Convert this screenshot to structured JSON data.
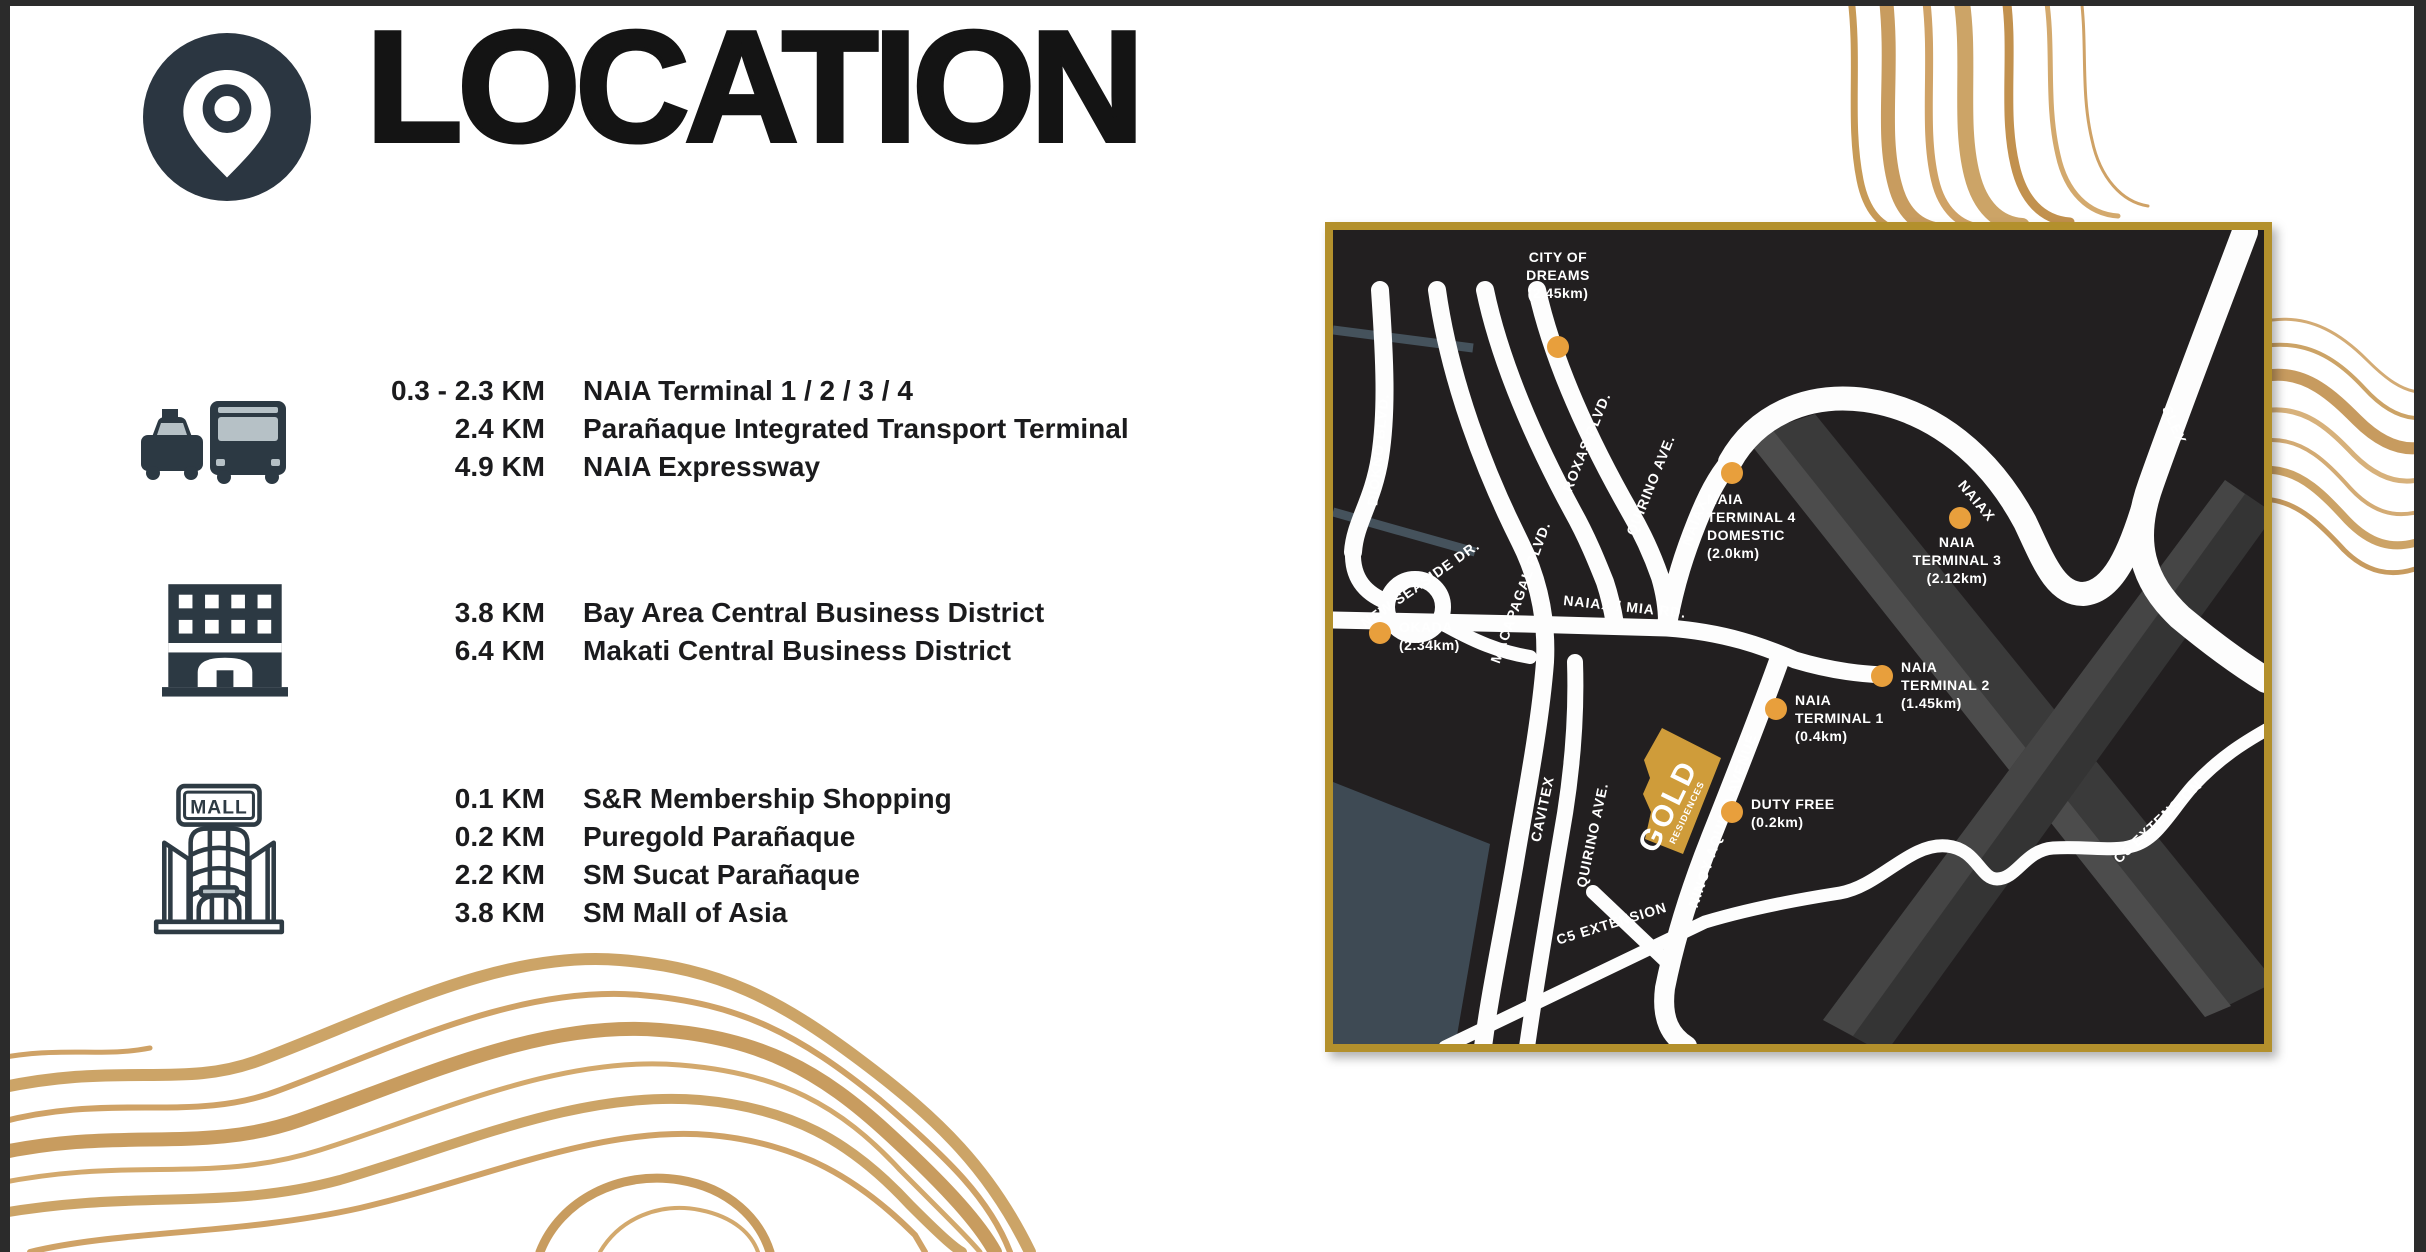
{
  "title": "LOCATION",
  "colors": {
    "ink": "#1b1b1d",
    "icon_dark": "#2c3943",
    "icon_light": "#b6c1c6",
    "map_bg": "#221f20",
    "map_border_gold": "#b3902c",
    "road_white": "#fdfdfd",
    "marker_orange": "#e89f3c",
    "property_gold": "#cf9c3a",
    "water_slate": "#3e4a54",
    "swirl_gold": "#c79a56"
  },
  "header": {
    "icon": "location-pin-icon"
  },
  "groups": [
    {
      "icon": "transport-icon",
      "rows": [
        {
          "distance": "0.3 - 2.3 KM",
          "name": "NAIA Terminal 1 / 2 / 3 / 4"
        },
        {
          "distance": "2.4 KM",
          "name": "Parañaque Integrated Transport Terminal"
        },
        {
          "distance": "4.9 KM",
          "name": "NAIA Expressway"
        }
      ]
    },
    {
      "icon": "building-icon",
      "rows": [
        {
          "distance": "3.8 KM",
          "name": "Bay Area Central Business District"
        },
        {
          "distance": "6.4 KM",
          "name": "Makati Central Business District"
        }
      ]
    },
    {
      "icon": "mall-icon",
      "icon_label": "MALL",
      "rows": [
        {
          "distance": "0.1 KM",
          "name": "S&R Membership Shopping"
        },
        {
          "distance": "0.2 KM",
          "name": "Puregold Parañaque"
        },
        {
          "distance": "2.2 KM",
          "name": "SM Sucat Parañaque"
        },
        {
          "distance": "3.8 KM",
          "name": "SM Mall of Asia"
        }
      ]
    }
  ],
  "map": {
    "road_labels": {
      "diokno": "DIOKNO BLVD.",
      "macapagal": "MACAPAGAL BLVD.",
      "roxas": "ROXAS BLVD.",
      "quirino_top": "QUIRINO AVE.",
      "naiax_v": "NAIAX",
      "naiax_arc": "NAIAX",
      "slex": "SLEX",
      "mia": "NAIAX / MIA RD.",
      "new_seaside": "NEW SEASIDE DR.",
      "cavitex": "CAVITEX",
      "quirino_bottom": "QUIRINO AVE.",
      "ninoy": "NINOY AQUINO AVENUE",
      "c5_a": "C5 EXTENSION",
      "c5_b": "C5 EXTENSION"
    },
    "property": {
      "name": "GOLD",
      "subname": "RESIDENCES"
    },
    "pois": [
      {
        "id": "city-of-dreams",
        "lines": [
          "CITY OF",
          "DREAMS",
          "(2.45km)"
        ]
      },
      {
        "id": "naia-terminal-4",
        "lines": [
          "NAIA",
          "TERMINAL 4",
          "DOMESTIC",
          "(2.0km)"
        ]
      },
      {
        "id": "naia-terminal-3",
        "lines": [
          "NAIA",
          "TERMINAL 3",
          "(2.12km)"
        ]
      },
      {
        "id": "naia-terminal-2",
        "lines": [
          "NAIA",
          "TERMINAL 2",
          "(1.45km)"
        ]
      },
      {
        "id": "naia-terminal-1",
        "lines": [
          "NAIA",
          "TERMINAL 1",
          "(0.4km)"
        ]
      },
      {
        "id": "duty-free",
        "lines": [
          "DUTY FREE",
          "(0.2km)"
        ]
      },
      {
        "id": "okada",
        "lines": [
          "OKADA",
          "(2.34km)"
        ]
      }
    ]
  }
}
